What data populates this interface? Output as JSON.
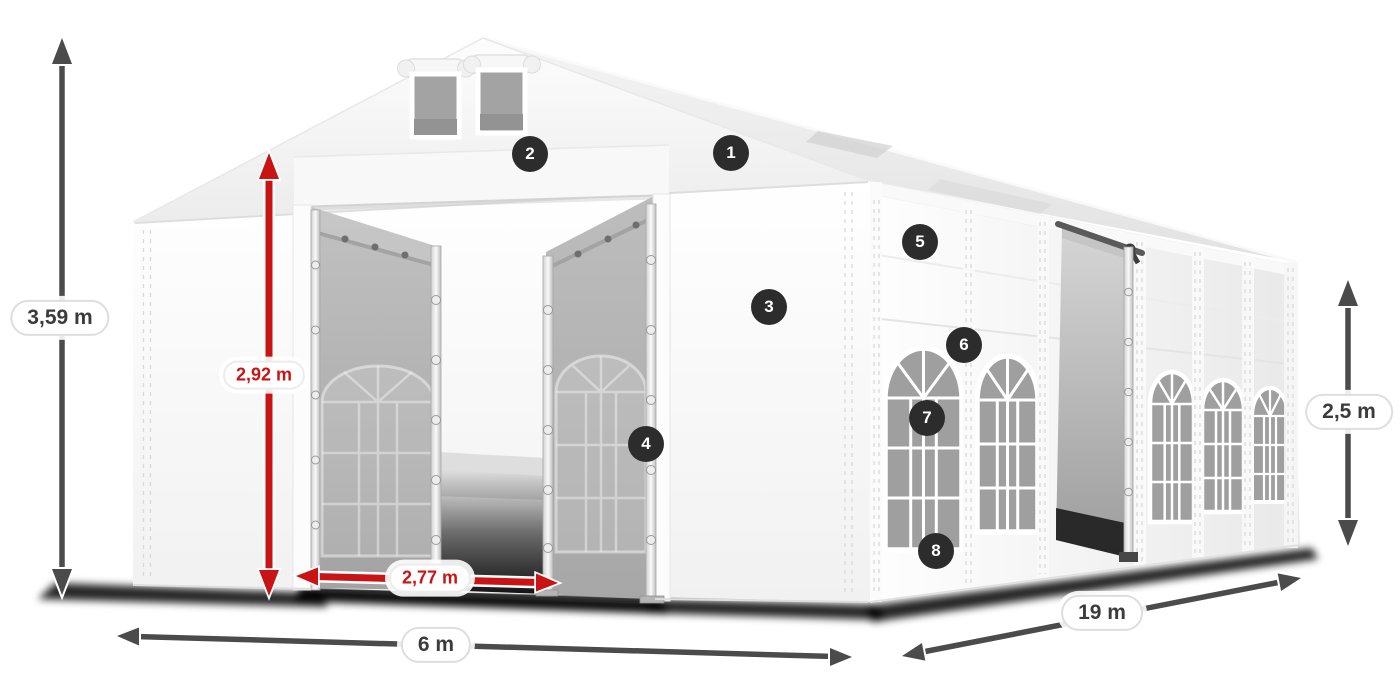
{
  "diagram": {
    "subject": "Party tent with dimension annotations",
    "dimension_labels": {
      "total_height": "3,59 m",
      "entrance_height": "2,92 m",
      "entrance_width": "2,77 m",
      "front_width": "6 m",
      "side_length": "19 m",
      "side_wall_height": "2,5 m"
    },
    "callout_numbers": [
      "1",
      "2",
      "3",
      "4",
      "5",
      "6",
      "7",
      "8"
    ],
    "colors": {
      "dimension_red": "#c81414",
      "dimension_gray": "#4b4b4b",
      "badge_background": "#2c2c2c",
      "badge_text": "#ffffff",
      "label_text": "#3b3b3b",
      "label_background": "#ffffff",
      "label_border": "#dedede"
    }
  }
}
